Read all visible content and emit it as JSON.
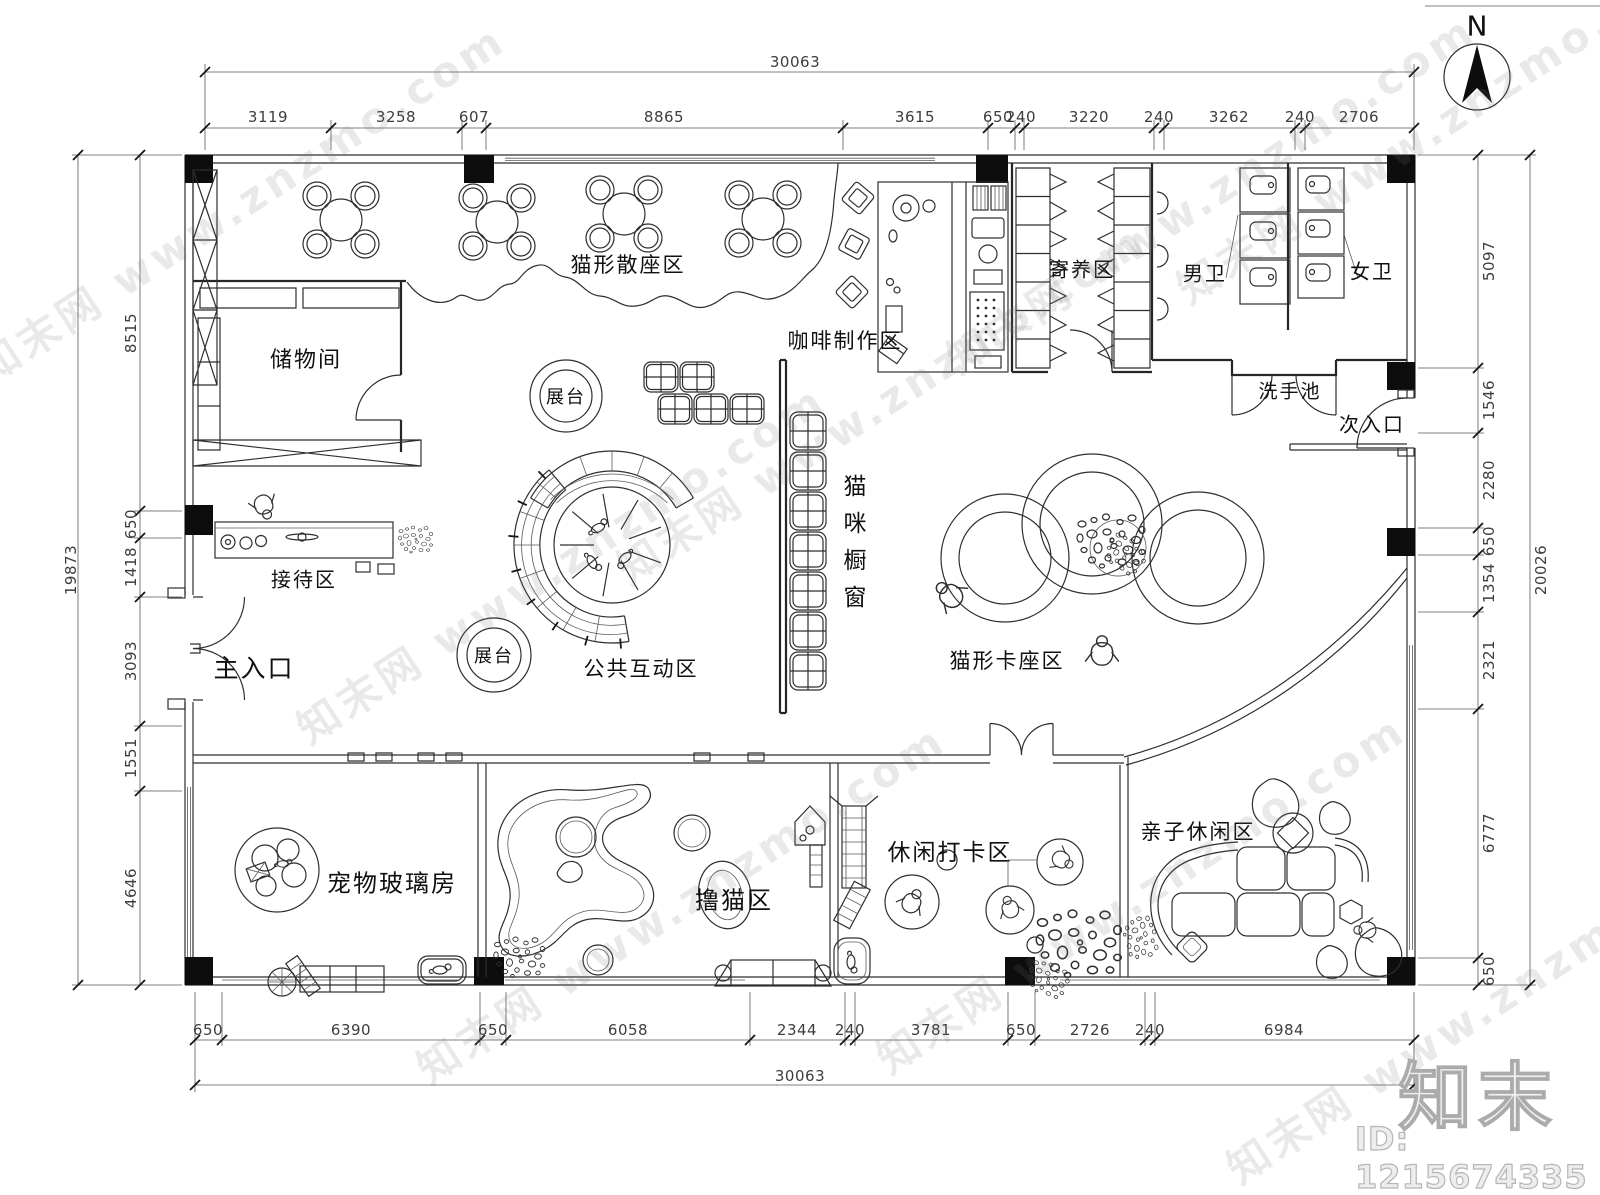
{
  "meta": {
    "north_label": "N",
    "watermark": "知末网 www.znzmo.com",
    "logo_text": "知末",
    "id_text": "ID: 1215674335"
  },
  "rooms": {
    "storage": "储物间",
    "cat_seating": "猫形散座区",
    "coffee": "咖啡制作区",
    "boarding": "寄养区",
    "mens": "男卫",
    "womens": "女卫",
    "sink": "洗手池",
    "side_entrance": "次入口",
    "display_top": "展台",
    "display_bottom": "展台",
    "cat_window": "猫咪橱窗",
    "reception": "接待区",
    "main_entrance": "主入口",
    "interaction": "公共互动区",
    "cat_booth": "猫形卡座区",
    "pet_glass": "宠物玻璃房",
    "cat_petting": "撸猫区",
    "checkin": "休闲打卡区",
    "family": "亲子休闲区"
  },
  "dimensions": {
    "top": {
      "total": "30063",
      "segments": [
        "3119",
        "3258",
        "607",
        "8865",
        "3615",
        "650",
        "240",
        "3220",
        "240",
        "3262",
        "240",
        "2706"
      ]
    },
    "bottom": {
      "total": "30063",
      "segments": [
        "650",
        "6390",
        "650",
        "6058",
        "2344",
        "240",
        "3781",
        "650",
        "2726",
        "240",
        "6984"
      ]
    },
    "left": {
      "total": "19873",
      "segments": [
        "8515",
        "650",
        "1418",
        "3093",
        "1551",
        "4646"
      ]
    },
    "right": {
      "total": "20026",
      "segments": [
        "5097",
        "1546",
        "2280",
        "650",
        "1354",
        "2321",
        "6777",
        "650"
      ]
    }
  }
}
